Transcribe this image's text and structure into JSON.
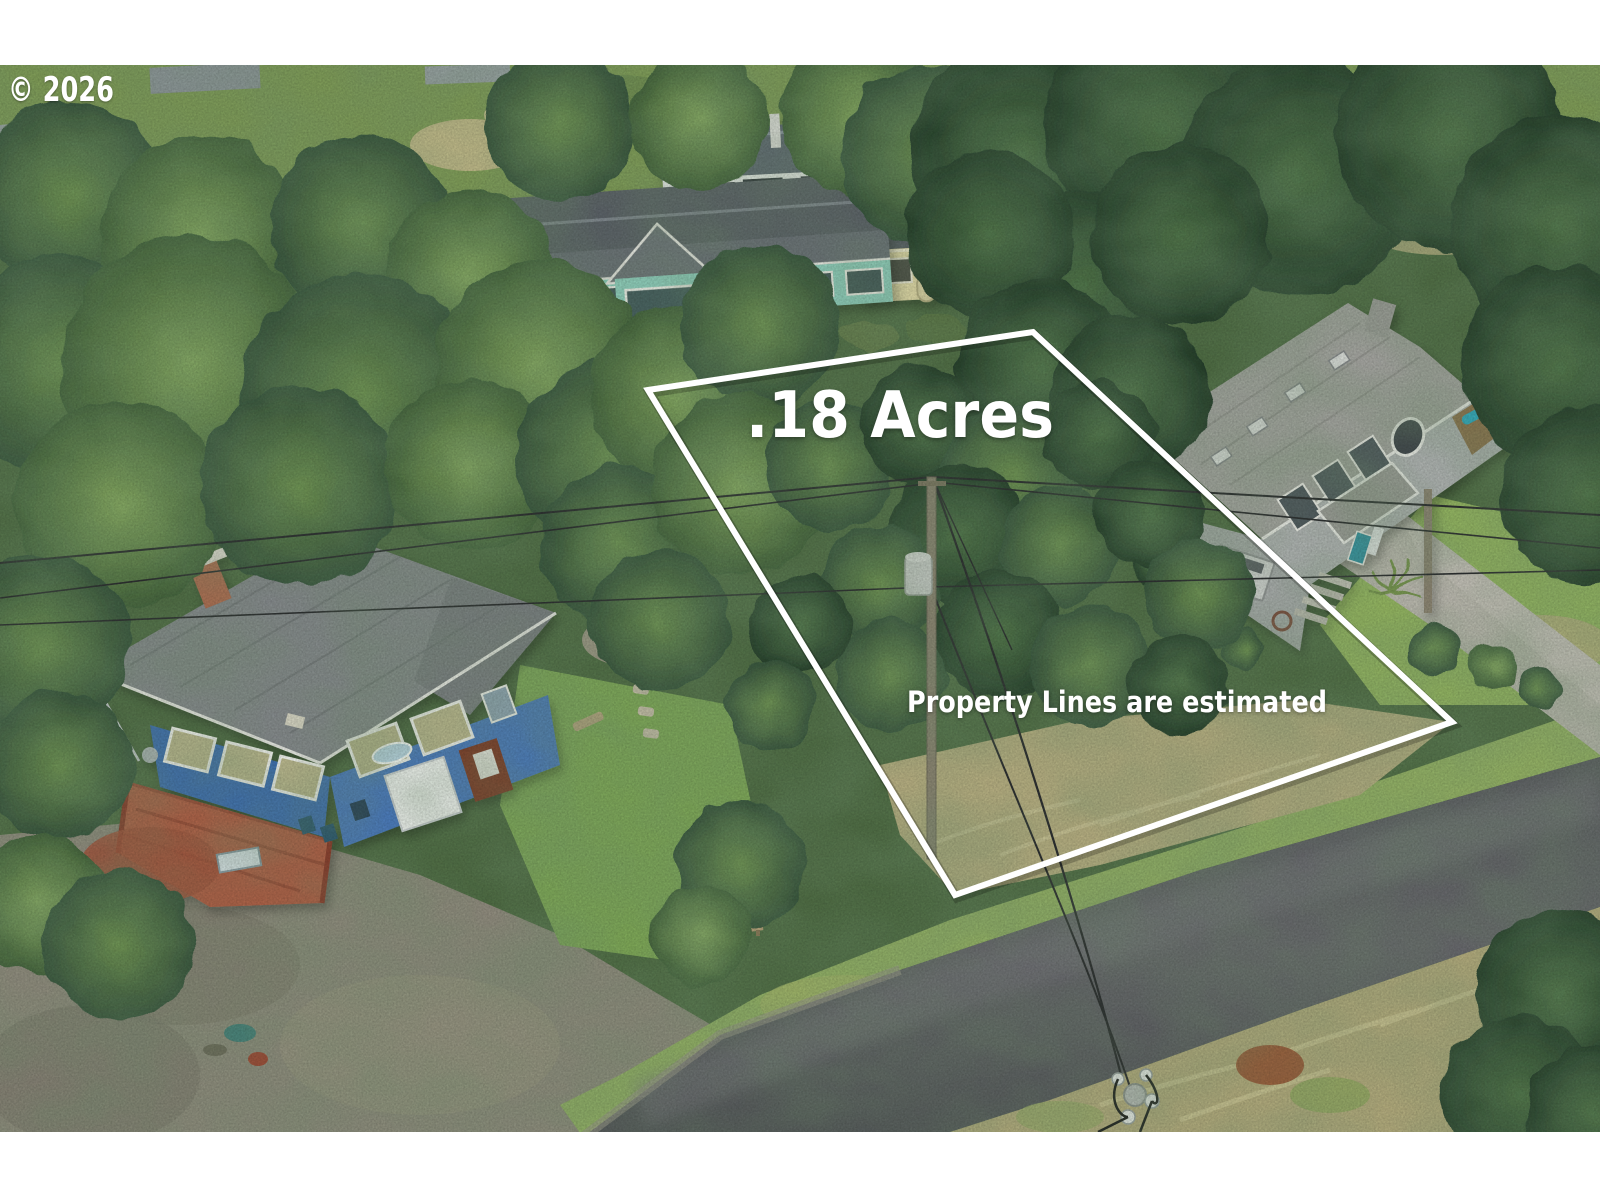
{
  "watermark": {
    "text": "© 2026"
  },
  "overlays": {
    "acreage_label": ".18 Acres",
    "disclaimer": "Property Lines are estimated",
    "outline_color": "#ffffff"
  },
  "palette": {
    "letterbox": "#ffffff",
    "forest_green": "#4d6a42",
    "dark_conifer": "#2c4630",
    "road_asphalt": "#56575c",
    "gravel": "#8e897c",
    "dry_grass": "#b5ab7e",
    "lawn_green": "#8fae62",
    "blue_house": "#3b6cb0",
    "teal_house": "#8fd0c0",
    "yellow_house": "#e6daa8",
    "gray_house_wall": "#aeb1b1",
    "deck_red": "#b05a42",
    "concrete": "#b9b6ad"
  }
}
